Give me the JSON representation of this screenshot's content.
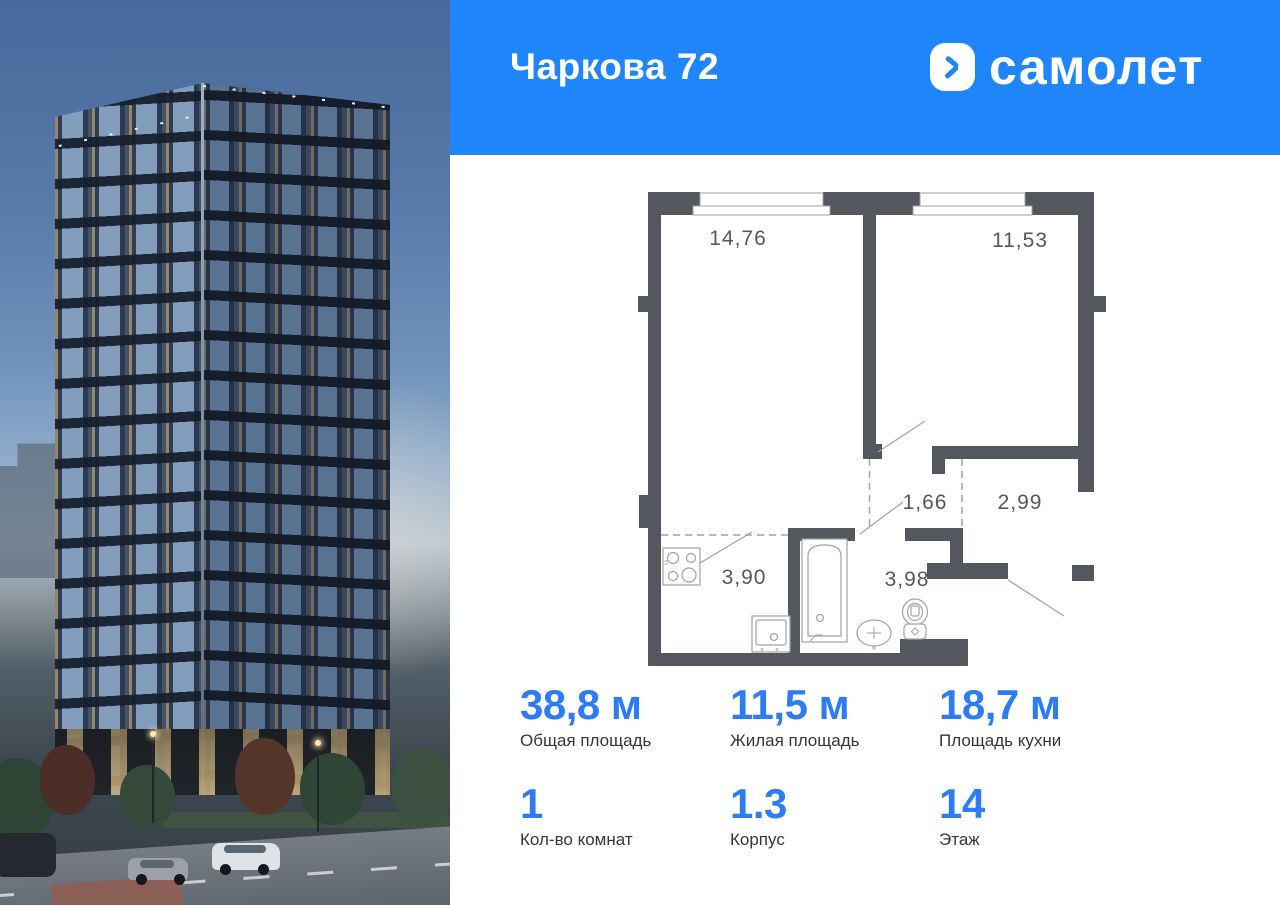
{
  "header": {
    "title": "Чаркова 72",
    "brand": "самолет"
  },
  "icons": {
    "brand": "samolet-arrow-icon"
  },
  "colors": {
    "accent": "#1e86fa",
    "stat_number": "#2d7cf6",
    "wall": "#54575e"
  },
  "plan": {
    "rooms": [
      {
        "id": "living-room",
        "area": "14,76"
      },
      {
        "id": "bedroom",
        "area": "11,53"
      },
      {
        "id": "hall",
        "area": "1,66"
      },
      {
        "id": "corridor",
        "area": "2,99"
      },
      {
        "id": "kitchen-zone",
        "area": "3,90"
      },
      {
        "id": "bathroom",
        "area": "3,98"
      }
    ]
  },
  "stats": [
    {
      "value": "38,8 м",
      "label": "Общая площадь"
    },
    {
      "value": "11,5 м",
      "label": "Жилая площадь"
    },
    {
      "value": "18,7 м",
      "label": "Площадь кухни"
    },
    {
      "value": "1",
      "label": "Кол-во комнат"
    },
    {
      "value": "1.3",
      "label": "Корпус"
    },
    {
      "value": "14",
      "label": "Этаж"
    }
  ]
}
